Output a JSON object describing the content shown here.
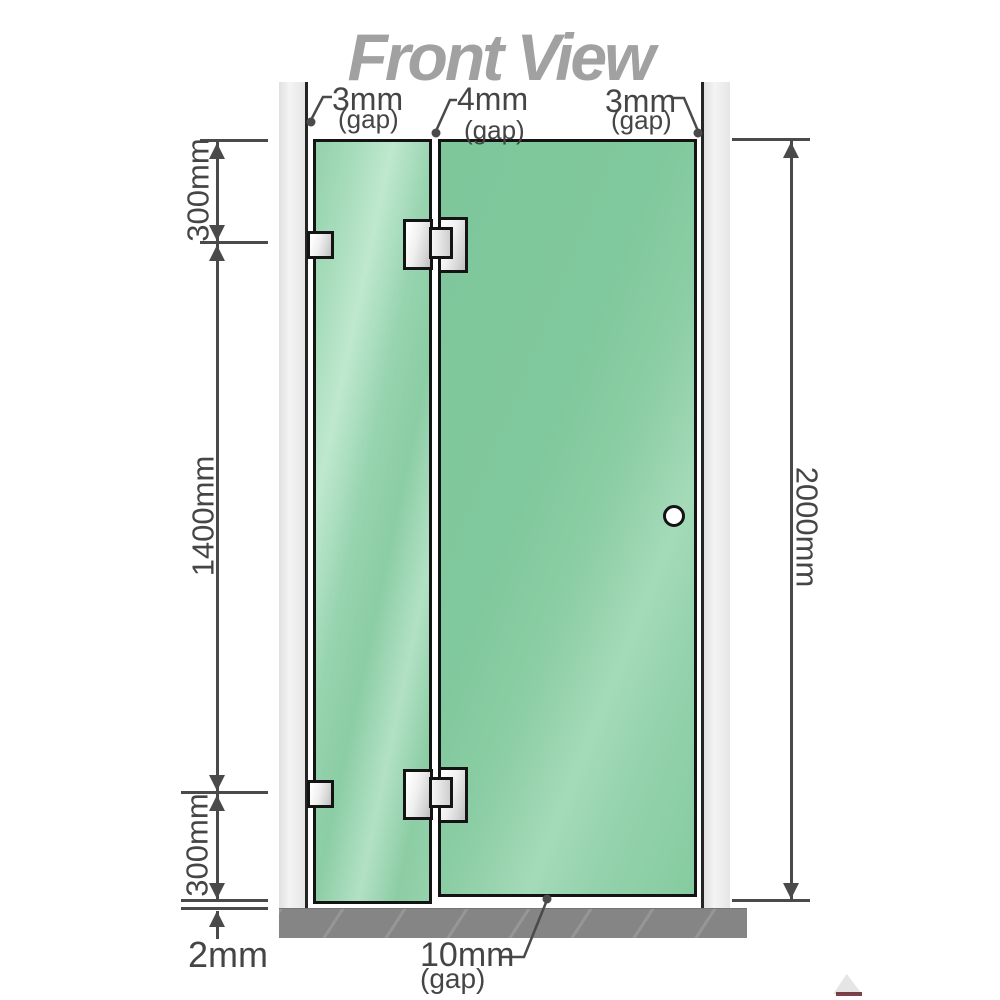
{
  "title": "Front View",
  "colors": {
    "glass_green": "#85cba0",
    "glass_highlight": "#bce8cf",
    "wall_gray": "#ebebeb",
    "floor_gray": "#858585",
    "outline_black": "#141414",
    "dimension_gray": "#4a4a4a",
    "title_gray": "#a1a1a1"
  },
  "dimensions": {
    "top_section": "300mm",
    "middle_section": "1400mm",
    "bottom_section": "300mm",
    "floor_clearance": "2mm",
    "overall_height": "2000mm"
  },
  "gaps": {
    "wall_left": {
      "value": "3mm",
      "label": "(gap)"
    },
    "panel_middle": {
      "value": "4mm",
      "label": "(gap)"
    },
    "wall_right": {
      "value": "3mm",
      "label": "(gap)"
    },
    "door_bottom": {
      "value": "10mm",
      "label": "(gap)"
    }
  }
}
